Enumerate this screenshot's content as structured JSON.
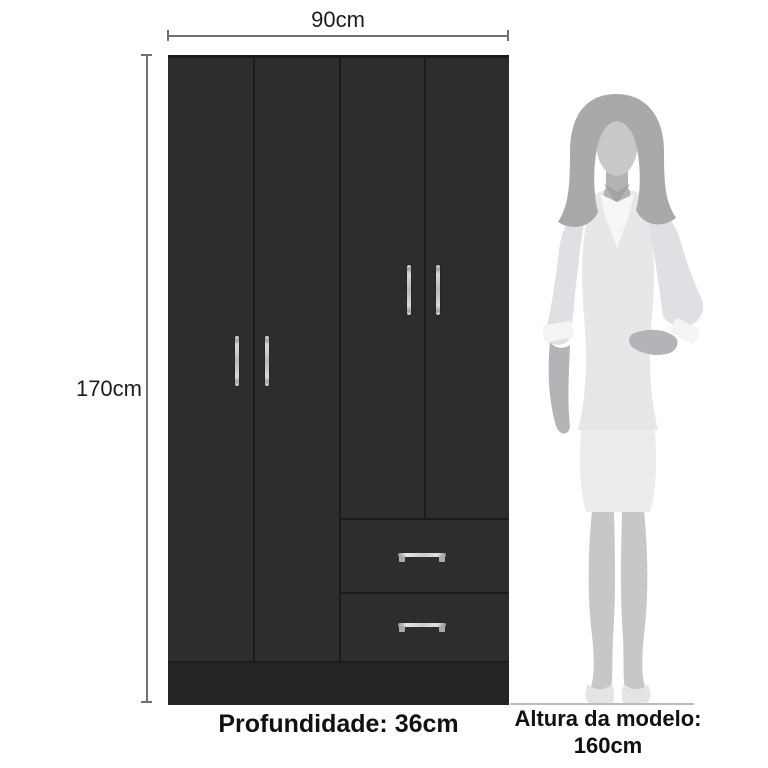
{
  "page": {
    "background_color": "#ffffff"
  },
  "annotations": {
    "width_label": "90cm",
    "height_label": "170cm",
    "depth_label": "Profundidade: 36cm",
    "model_height_line1": "Altura da modelo:",
    "model_height_line2": "160cm",
    "line_color": "#707070",
    "text_color": "#1c1c1c"
  },
  "wardrobe": {
    "door_count": 4,
    "drawer_count": 2,
    "body_color": "#2d2d2d",
    "seam_color": "#1b1b1b",
    "base_color": "#242424",
    "handle_color": "#cccccc"
  },
  "model_figure": {
    "description": "standing woman silhouette",
    "hair_color": "#a8a9ab",
    "skin_color": "#c7c8ca",
    "neck_color": "#b2b3b5",
    "neck_shadow_color": "#a2a3a5",
    "outfit_color": "#e6e7e9",
    "arm_color": "#dfe0e3",
    "cuff_color": "#f3f4f6",
    "hand_color": "#b3b4b7",
    "collar_color": "#f6f6f8",
    "skirt_color": "#ebecee",
    "legs_color": "#c6c7c9",
    "shoes_color": "#e3e4e6",
    "ground_line_color": "#bcbcbc"
  }
}
